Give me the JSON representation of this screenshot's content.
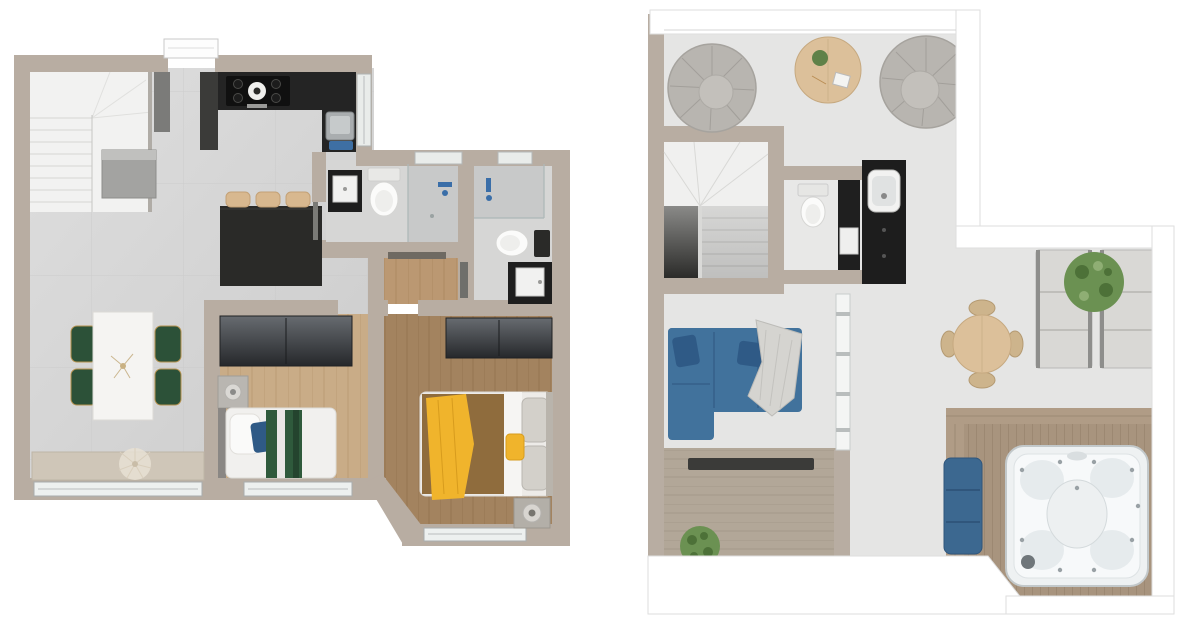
{
  "title": "Two-storey apartment 3D floor plans, top-down view",
  "palette": {
    "background": "#ffffff",
    "wall": "#b8ada2",
    "wall_light": "#c7bdb2",
    "tile_floor": "#d7d7d7",
    "concrete_floor": "#e5e5e4",
    "wood_light": "#c9ac87",
    "wood_medium": "#bb9872",
    "wood_dark": "#a3835f",
    "deck_wood": "#a8947e",
    "counter_black": "#1f1f1f",
    "stainless": "#a9adaf",
    "fixture_white": "#f2f2f1",
    "sofa_blue": "#41729c",
    "pillow_blue": "#2f5a86",
    "bench_blue": "#3c6890",
    "mat_blue": "#3e6fa3",
    "shower_blue": "#3a6ea8",
    "chair_green": "#2c5138",
    "blanket_green": "#2f5a3c",
    "accent_yellow": "#f0b42c",
    "duvet_brown": "#8f6c3d",
    "pouf_gray": "#b8b5b0",
    "table_wood": "#dcc09a",
    "plant_green": "#6b9152",
    "glass": "#e9ecea"
  },
  "floor_plans": [
    {
      "id": "lower-floor",
      "position": "left",
      "rooms": [
        {
          "name": "staircase",
          "furniture": [
            "l-shaped-stair",
            "storage-box",
            "tall-cabinet",
            "black-column-cabinet"
          ]
        },
        {
          "name": "kitchen",
          "furniture": [
            "l-shaped-black-counter",
            "cooktop",
            "stainless-sink",
            "blue-sink-mat",
            "island",
            "bar-stool",
            "bar-stool",
            "bar-stool"
          ]
        },
        {
          "name": "living-dining",
          "furniture": [
            "white-dining-table",
            "green-chair",
            "green-chair",
            "green-chair",
            "green-chair",
            "window-bench",
            "dried-plant"
          ]
        },
        {
          "name": "entry-hall",
          "furniture": [
            "entry-door",
            "oak-floor"
          ]
        },
        {
          "name": "bathroom-1",
          "furniture": [
            "black-vanity-with-sink",
            "toilet",
            "walk-in-shower"
          ]
        },
        {
          "name": "bathroom-2",
          "furniture": [
            "shower",
            "toilet",
            "black-vanity-with-sink"
          ]
        },
        {
          "name": "bedroom-1",
          "furniture": [
            "wardrobe",
            "nightstand-with-lamp",
            "single-bed-green-bedding",
            "window"
          ]
        },
        {
          "name": "bedroom-2",
          "furniture": [
            "wardrobe",
            "double-bed-brown-yellow-bedding",
            "nightstand-with-lamp",
            "bay-window"
          ]
        }
      ]
    },
    {
      "id": "upper-floor",
      "position": "right",
      "rooms": [
        {
          "name": "roof-lounge",
          "furniture": [
            "round-pouf",
            "round-pouf",
            "round-coffee-table",
            "small-plant"
          ]
        },
        {
          "name": "staircase",
          "furniture": [
            "u-shaped-stair"
          ]
        },
        {
          "name": "wc",
          "furniture": [
            "toilet",
            "black-wall-unit",
            "towel-holder"
          ]
        },
        {
          "name": "wet-bar",
          "furniture": [
            "black-bar-counter",
            "white-sink"
          ]
        },
        {
          "name": "living-room",
          "furniture": [
            "blue-corner-sofa",
            "throw-blanket",
            "tv-bench",
            "floor-plant"
          ]
        },
        {
          "name": "terrace",
          "furniture": [
            "round-dining-table",
            "wicker-chair",
            "wicker-chair",
            "wicker-chair",
            "wicker-chair",
            "sun-lounger",
            "sun-lounger",
            "shrub"
          ]
        },
        {
          "name": "spa-deck",
          "furniture": [
            "timber-deck",
            "hot-tub",
            "blue-bench"
          ]
        }
      ]
    }
  ]
}
